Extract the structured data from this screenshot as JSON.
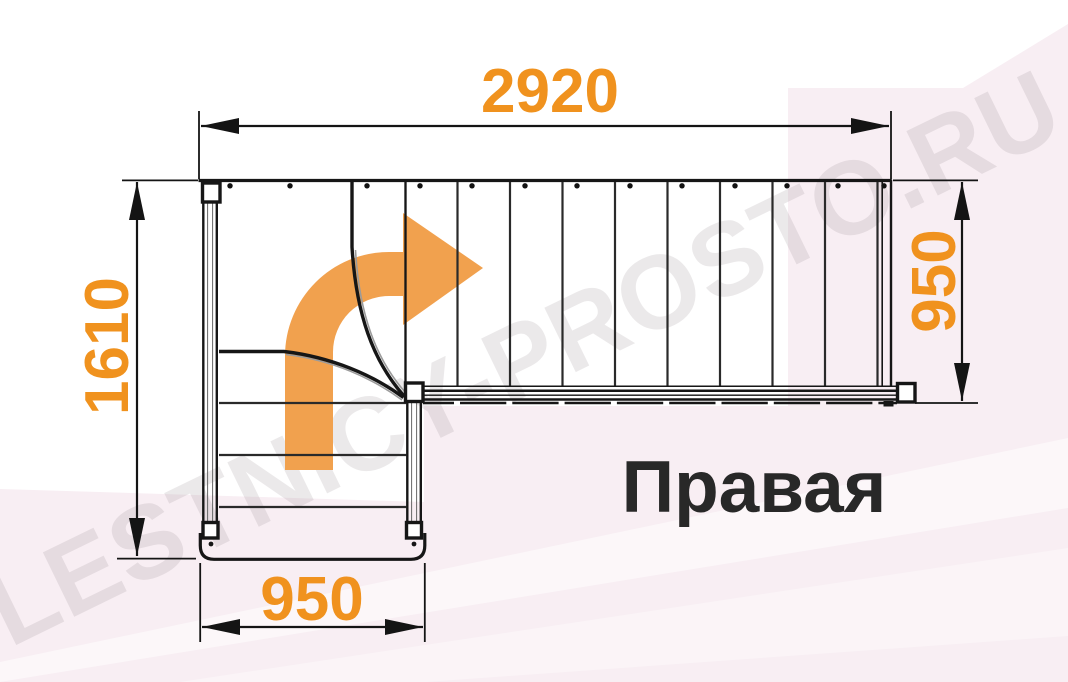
{
  "title_label": "Правая",
  "watermark": "LESTNICY-PROSTO.RU",
  "dimensions": {
    "top_width": "2920",
    "left_height": "1610",
    "right_height": "950",
    "bottom_width": "950"
  },
  "colors": {
    "dimension_text": "#F0921E",
    "arrow_fill": "#F1A14E",
    "line": "#161616",
    "label_text": "#282828",
    "background_pink": "#F8EEF3",
    "watermark_gray": "#8A7D84"
  },
  "drawing": {
    "type": "staircase-plan-right-turn",
    "upper_flight_treads_x": [
      405.5,
      457.5,
      510,
      562.5,
      615,
      667.5,
      720,
      772.5,
      825,
      877.5
    ],
    "upper_flight_dots_x": [
      230,
      290,
      367,
      420,
      472,
      525,
      577,
      630,
      682,
      735,
      787,
      838,
      884
    ],
    "lower_flight_treads_y": [
      403,
      455,
      507
    ],
    "winder_step_count": 3
  }
}
